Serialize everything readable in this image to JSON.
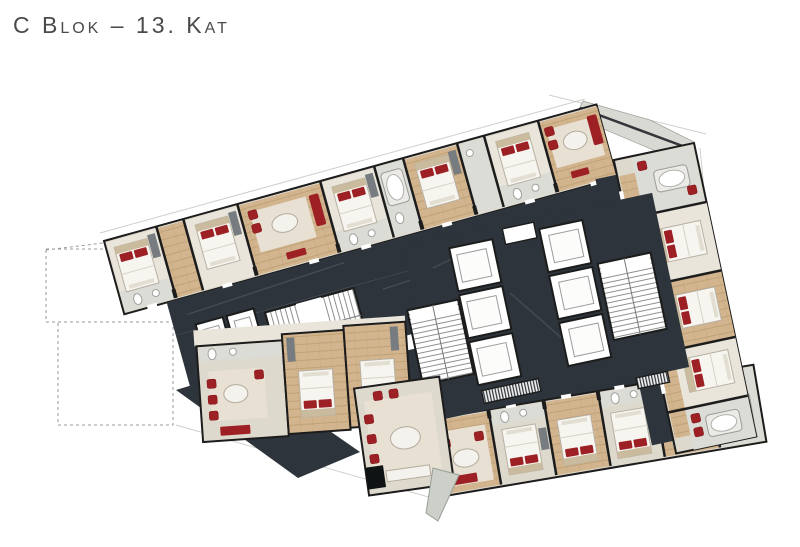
{
  "header": {
    "title": "C Blok – 13. Kat"
  },
  "palette": {
    "background": "#ffffff",
    "title_color": "#4a4a4a",
    "corridor": "#2d343b",
    "wall": "#1c1c1c",
    "floor": "#ded9cd",
    "carpet": "#eae5db",
    "wood_base": "#d2b48e",
    "wood_line": "#c0a277",
    "bath": "#dcdcd7",
    "red": "#9d2025",
    "closet": "#767c7f",
    "terrace": "#d9d9d4",
    "outline_gray": "#9a9a9a"
  }
}
